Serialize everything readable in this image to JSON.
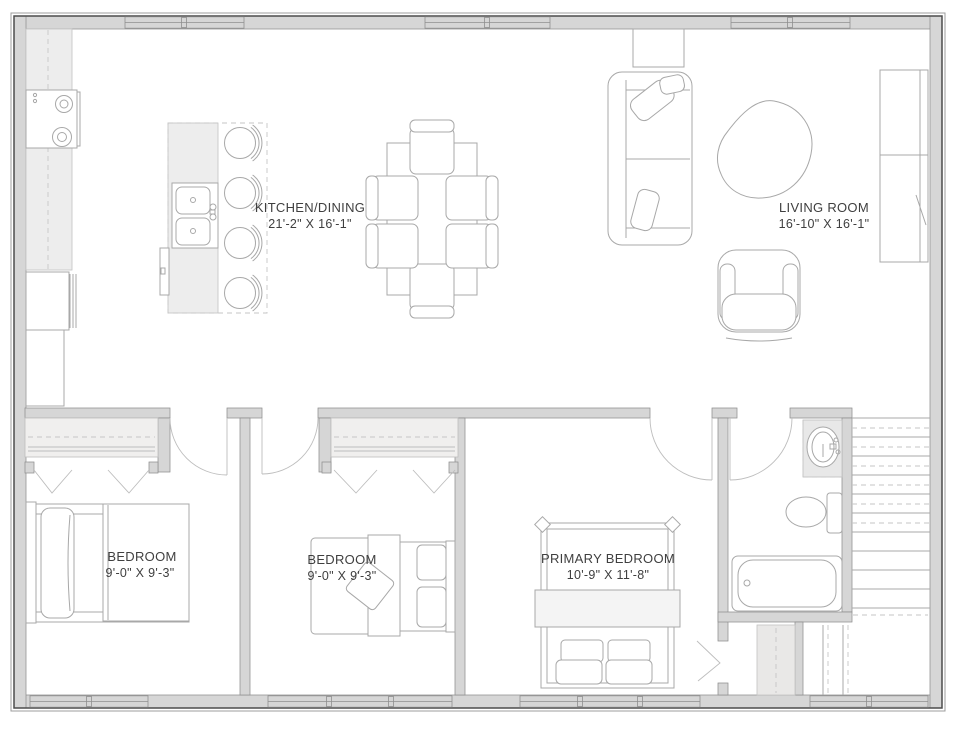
{
  "plan": {
    "type": "floor-plan",
    "rooms": {
      "kitchen_dining": {
        "name": "KITCHEN/DINING",
        "dims": "21'-2\" X 16'-1\""
      },
      "living_room": {
        "name": "LIVING ROOM",
        "dims": "16'-10\" X 16'-1\""
      },
      "bedroom_1": {
        "name": "BEDROOM",
        "dims": "9'-0\" X 9'-3\""
      },
      "bedroom_2": {
        "name": "BEDROOM",
        "dims": "9'-0\" X 9'-3\""
      },
      "primary_bedroom": {
        "name": "PRIMARY BEDROOM",
        "dims": "10'-9\" X 11'-8\""
      }
    },
    "colors": {
      "wall_fill": "#d6d6d6",
      "furniture_line": "#a8a8a8",
      "label_text": "#3f3f3f",
      "background": "#ffffff"
    }
  }
}
